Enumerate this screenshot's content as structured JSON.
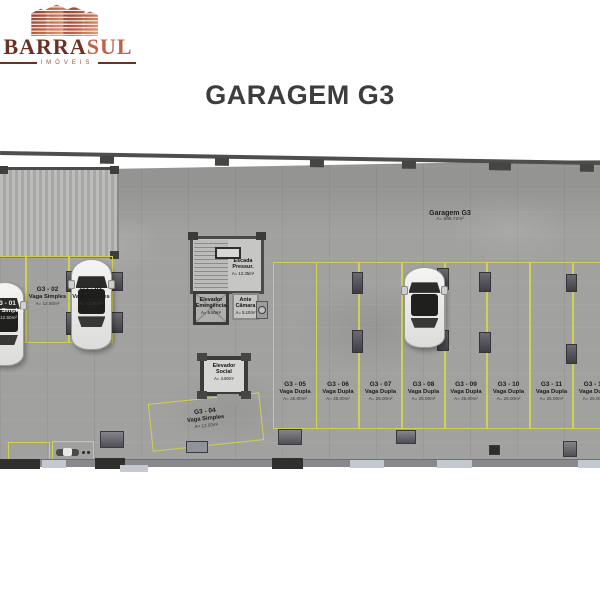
{
  "brand": {
    "name_primary": "BARRA",
    "name_secondary": "SUL",
    "tagline": "IMÓVEIS"
  },
  "page_title": "GARAGEM G3",
  "plan": {
    "floor_label": {
      "name": "Garagem G3",
      "area": "A= 698.72m²"
    },
    "rooms": {
      "stairs": {
        "line1": "Escada",
        "line2": "Pressur.",
        "area": "A= 12.35m²"
      },
      "emergency_elevator": {
        "line1": "Elevador",
        "line2": "Emergência",
        "area": "A= 6.50m²"
      },
      "ante_chamber": {
        "line1": "Ante",
        "line2": "Câmara",
        "area": "A= 5.10m²"
      },
      "social_elevator": {
        "line1": "Elevador",
        "line2": "Social",
        "area": "A= 4.60m²"
      }
    },
    "left_spots": [
      {
        "id": "G3 - 01",
        "type": "Vaga Simples",
        "area": "A= 12.50m²",
        "occupied": true
      },
      {
        "id": "G3 - 02",
        "type": "Vaga Simples",
        "area": "A= 12.50m²",
        "occupied": false
      },
      {
        "id": "G3 - 03",
        "type": "Vaga Simples",
        "area": "A= 12.50m²",
        "occupied": true
      }
    ],
    "diagonal_spot": {
      "id": "G3 - 04",
      "type": "Vaga Simples",
      "area": "A= 12.50m²",
      "occupied": false
    },
    "right_spots": [
      {
        "id": "G3 - 05",
        "type": "Vaga Dupla",
        "area": "A= 25.00m²",
        "occupied": false
      },
      {
        "id": "G3 - 06",
        "type": "Vaga Dupla",
        "area": "A= 25.00m²",
        "occupied": false
      },
      {
        "id": "G3 - 07",
        "type": "Vaga Dupla",
        "area": "A= 25.00m²",
        "occupied": false
      },
      {
        "id": "G3 - 08",
        "type": "Vaga Dupla",
        "area": "A= 25.00m²",
        "occupied": true
      },
      {
        "id": "G3 - 09",
        "type": "Vaga Dupla",
        "area": "A= 25.00m²",
        "occupied": false
      },
      {
        "id": "G3 - 10",
        "type": "Vaga Dupla",
        "area": "A= 25.00m²",
        "occupied": false
      },
      {
        "id": "G3 - 11",
        "type": "Vaga Dupla",
        "area": "A= 25.00m²",
        "occupied": false
      },
      {
        "id": "G3 - 12",
        "type": "Vaga Dupla",
        "area": "A= 25.00m²",
        "occupied": false
      }
    ]
  },
  "colors": {
    "accent_yellow": "#d5d34c",
    "brand_dark": "#6b3124",
    "brand_accent": "#c2604a",
    "floor_gray": "#a1a19f",
    "wall_dark": "#4a4a48",
    "title_gray": "#3d3d3d"
  }
}
